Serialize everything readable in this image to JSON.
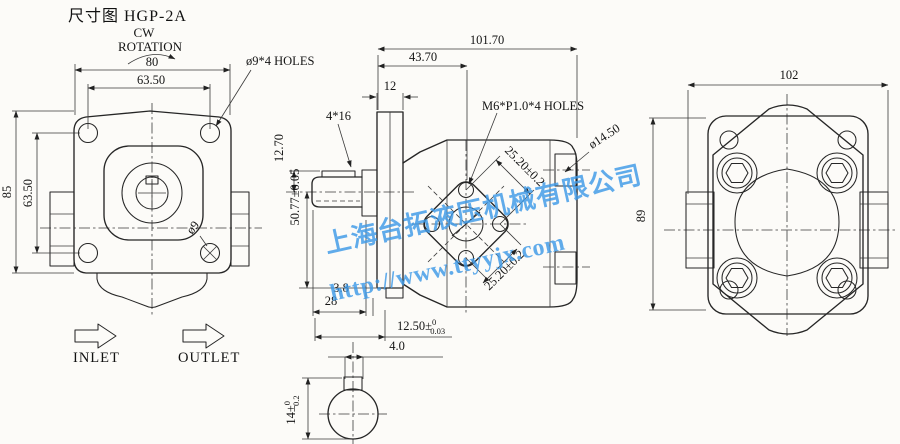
{
  "title": "尺寸图 HGP-2A",
  "rotation": {
    "line1": "CW",
    "line2": "ROTATION"
  },
  "flow": {
    "inlet": "INLET",
    "outlet": "OUTLET"
  },
  "front_view": {
    "dim_width_outer": "80",
    "dim_bolt_spacing_h": "63.50",
    "dim_height_outer": "85",
    "dim_bolt_spacing_v": "63.50",
    "label_mount_holes": "ø9*4 HOLES",
    "label_hole_dia": "ø9"
  },
  "side_view": {
    "dim_total_length": "101.70",
    "dim_body_length": "43.70",
    "dim_flange_thickness": "12",
    "label_key": "4*16",
    "label_thread_holes": "M6*P1.0*4 HOLES",
    "label_port_thread": "ø14.50",
    "dim_key_height": "12.70",
    "dim_port_center_height": "50.77±0.05",
    "dim_hole_spacing_upper": "25.20±0.2",
    "dim_hole_spacing_lower": "25.20±0.2",
    "dim_step": "3.8",
    "dim_shaft_length": "28",
    "dim_port_depth": {
      "main": "12.50±",
      "sup": "0",
      "sub": "0.03"
    }
  },
  "shaft_detail": {
    "dim_key_width": "4.0",
    "dim_across_key": {
      "main": "14±",
      "sup": "0",
      "sub": "0.2"
    }
  },
  "rear_view": {
    "dim_width": "102",
    "dim_height": "89"
  },
  "watermark": {
    "company": "上海台拓液压机械有限公司",
    "url": "http://www.ttyyjx.com",
    "color": "#3e9ae8"
  }
}
